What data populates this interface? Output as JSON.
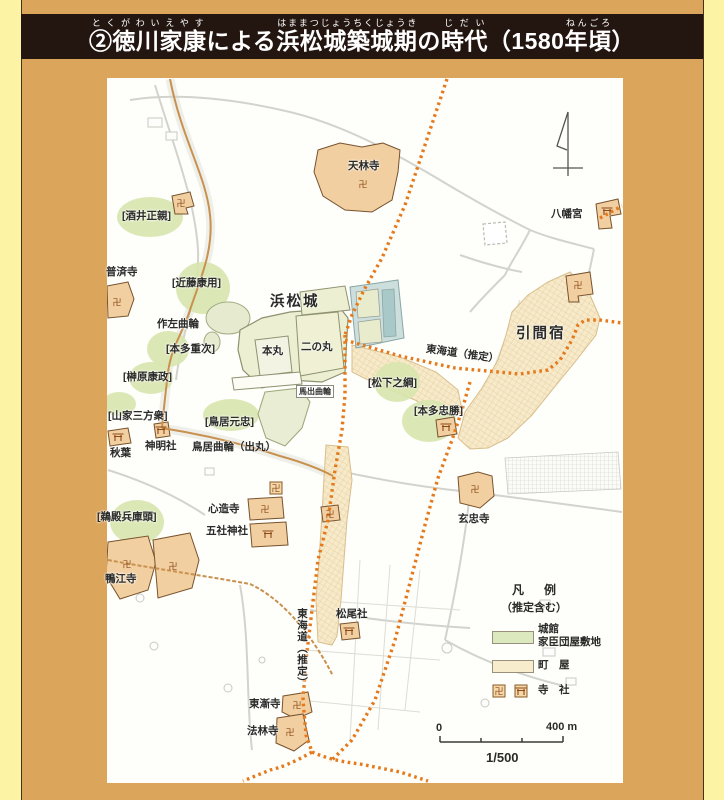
{
  "title": {
    "segments": [
      {
        "t": "②徳川家康",
        "r": "とくがわいえやす"
      },
      {
        "t": "による"
      },
      {
        "t": "浜松城築城期",
        "r": "はままつじょうちくじょうき"
      },
      {
        "t": "の"
      },
      {
        "t": "時代",
        "r": "じだい"
      },
      {
        "t": "（1580"
      },
      {
        "t": "年頃",
        "r": "ねんごろ"
      },
      {
        "t": "）"
      }
    ]
  },
  "map": {
    "labels": [
      {
        "id": "label-sakai-masachika",
        "text": "[酒井正親]",
        "x": 122,
        "y": 211
      },
      {
        "id": "label-fusaiji",
        "text": "普済寺",
        "x": 106,
        "y": 267
      },
      {
        "id": "label-kondo-yasumochi",
        "text": "[近藤康用]",
        "x": 172,
        "y": 278
      },
      {
        "id": "label-tenrinji",
        "text": "天林寺",
        "x": 348,
        "y": 161
      },
      {
        "id": "label-sakuza-kuruwa",
        "text": "作左曲輪",
        "x": 157,
        "y": 319
      },
      {
        "id": "label-honda-shigetsugu",
        "text": "[本多重次]",
        "x": 166,
        "y": 344
      },
      {
        "id": "label-hamamatsu-castle",
        "text": "浜松城",
        "x": 270,
        "y": 295,
        "cls": "big"
      },
      {
        "id": "label-honmaru",
        "text": "本丸",
        "x": 262,
        "y": 346
      },
      {
        "id": "label-ninomaru",
        "text": "二の丸",
        "x": 301,
        "y": 342
      },
      {
        "id": "label-sakakibara-yasumasa",
        "text": "[榊原康政]",
        "x": 123,
        "y": 372
      },
      {
        "id": "label-yamaga-sanposhu",
        "text": "[山家三方衆]",
        "x": 108,
        "y": 411
      },
      {
        "id": "label-torii-mototada",
        "text": "[鳥居元忠]",
        "x": 205,
        "y": 417
      },
      {
        "id": "label-umadashi-kuruwa",
        "text": "馬出曲輪",
        "x": 296,
        "y": 385,
        "cls": "boxed"
      },
      {
        "id": "label-matsushita-yukitsuna",
        "text": "[松下之綱]",
        "x": 368,
        "y": 378
      },
      {
        "id": "label-honda-tadakatsu",
        "text": "[本多忠勝]",
        "x": 414,
        "y": 406
      },
      {
        "id": "label-tokaido-east",
        "text": "東海道（推定）",
        "x": 426,
        "y": 344,
        "rot": 8
      },
      {
        "id": "label-hikuma-juku",
        "text": "引間宿",
        "x": 516,
        "y": 327,
        "cls": "big"
      },
      {
        "id": "label-hachimangu",
        "text": "八幡宮",
        "x": 551,
        "y": 209
      },
      {
        "id": "label-shinmeisha",
        "text": "神明社",
        "x": 145,
        "y": 441
      },
      {
        "id": "label-akiba",
        "text": "秋葉",
        "x": 110,
        "y": 448
      },
      {
        "id": "label-torii-kuruwa-demaru",
        "text": "鳥居曲輪（出丸）",
        "x": 192,
        "y": 442
      },
      {
        "id": "label-udono-hyogonokami",
        "text": "[鵜殿兵庫頭]",
        "x": 97,
        "y": 512
      },
      {
        "id": "label-shinzoji",
        "text": "心造寺",
        "x": 208,
        "y": 504
      },
      {
        "id": "label-gosha-jinja",
        "text": "五社神社",
        "x": 206,
        "y": 526
      },
      {
        "id": "label-kamoeji",
        "text": "鴨江寺",
        "x": 105,
        "y": 574
      },
      {
        "id": "label-genchuji",
        "text": "玄忠寺",
        "x": 458,
        "y": 514
      },
      {
        "id": "label-matsuosha",
        "text": "松尾社",
        "x": 336,
        "y": 609
      },
      {
        "id": "label-tokaido-south",
        "text": "東海道（推定）",
        "x": 296,
        "y": 608,
        "cls": "vertical"
      },
      {
        "id": "label-tozenji",
        "text": "東漸寺",
        "x": 249,
        "y": 699
      },
      {
        "id": "label-horinji",
        "text": "法林寺",
        "x": 247,
        "y": 726
      }
    ],
    "legend": {
      "heading": "凡　例",
      "subheading": "（推定含む）",
      "item1_line1": "城館",
      "item1_line2": "家臣団屋敷地",
      "item2": "町　屋",
      "item3": "寺　社",
      "colors": {
        "castle_green": "#DCE8BE",
        "machiya_tan": "#F7ECCC"
      }
    },
    "scale": {
      "zero": "0",
      "max": "400 m",
      "ratio": "1/500"
    },
    "ellipses": [
      [
        150,
        217,
        33,
        20
      ],
      [
        203,
        288,
        27,
        26
      ],
      [
        168,
        349,
        21,
        18
      ],
      [
        151,
        378,
        22,
        16
      ],
      [
        119,
        404,
        17,
        12
      ],
      [
        231,
        415,
        28,
        16
      ],
      [
        397,
        382,
        23,
        20
      ],
      [
        429,
        421,
        27,
        21
      ],
      [
        137,
        522,
        27,
        22
      ]
    ],
    "symbols": [
      {
        "type": "manji",
        "x": 181,
        "y": 203
      },
      {
        "type": "manji",
        "x": 363,
        "y": 184
      },
      {
        "type": "manji",
        "x": 117,
        "y": 302
      },
      {
        "type": "manji",
        "x": 127,
        "y": 564
      },
      {
        "type": "manji",
        "x": 173,
        "y": 566
      },
      {
        "type": "manji",
        "x": 265,
        "y": 509
      },
      {
        "type": "manji",
        "x": 276,
        "y": 488,
        "box": true
      },
      {
        "type": "torii",
        "x": 268,
        "y": 534
      },
      {
        "type": "manji",
        "x": 475,
        "y": 489
      },
      {
        "type": "manji",
        "x": 297,
        "y": 705
      },
      {
        "type": "manji",
        "x": 290,
        "y": 732
      },
      {
        "type": "torii",
        "x": 349,
        "y": 631
      },
      {
        "type": "torii",
        "x": 607,
        "y": 211
      },
      {
        "type": "torii",
        "x": 118,
        "y": 437
      },
      {
        "type": "torii",
        "x": 161,
        "y": 430
      },
      {
        "type": "torii",
        "x": 446,
        "y": 427
      },
      {
        "type": "manji",
        "x": 578,
        "y": 285
      },
      {
        "type": "manji",
        "x": 330,
        "y": 514
      },
      {
        "type": "manji",
        "x": 499,
        "y": 691,
        "box": true
      },
      {
        "type": "torii",
        "x": 521,
        "y": 691,
        "box": true
      }
    ],
    "colors": {
      "panel": "#DBA55C",
      "title_bar": "#231611",
      "ellipse_green": "#D7E5AE",
      "castle_green": "#EDEFD2",
      "temple_tan": "#F2CFA0",
      "machiya_tan": "#F7EACA",
      "tokaido_orange": "#E5791B",
      "road_brown": "#C8914F",
      "moat_blue": "#CCDFDD"
    }
  }
}
